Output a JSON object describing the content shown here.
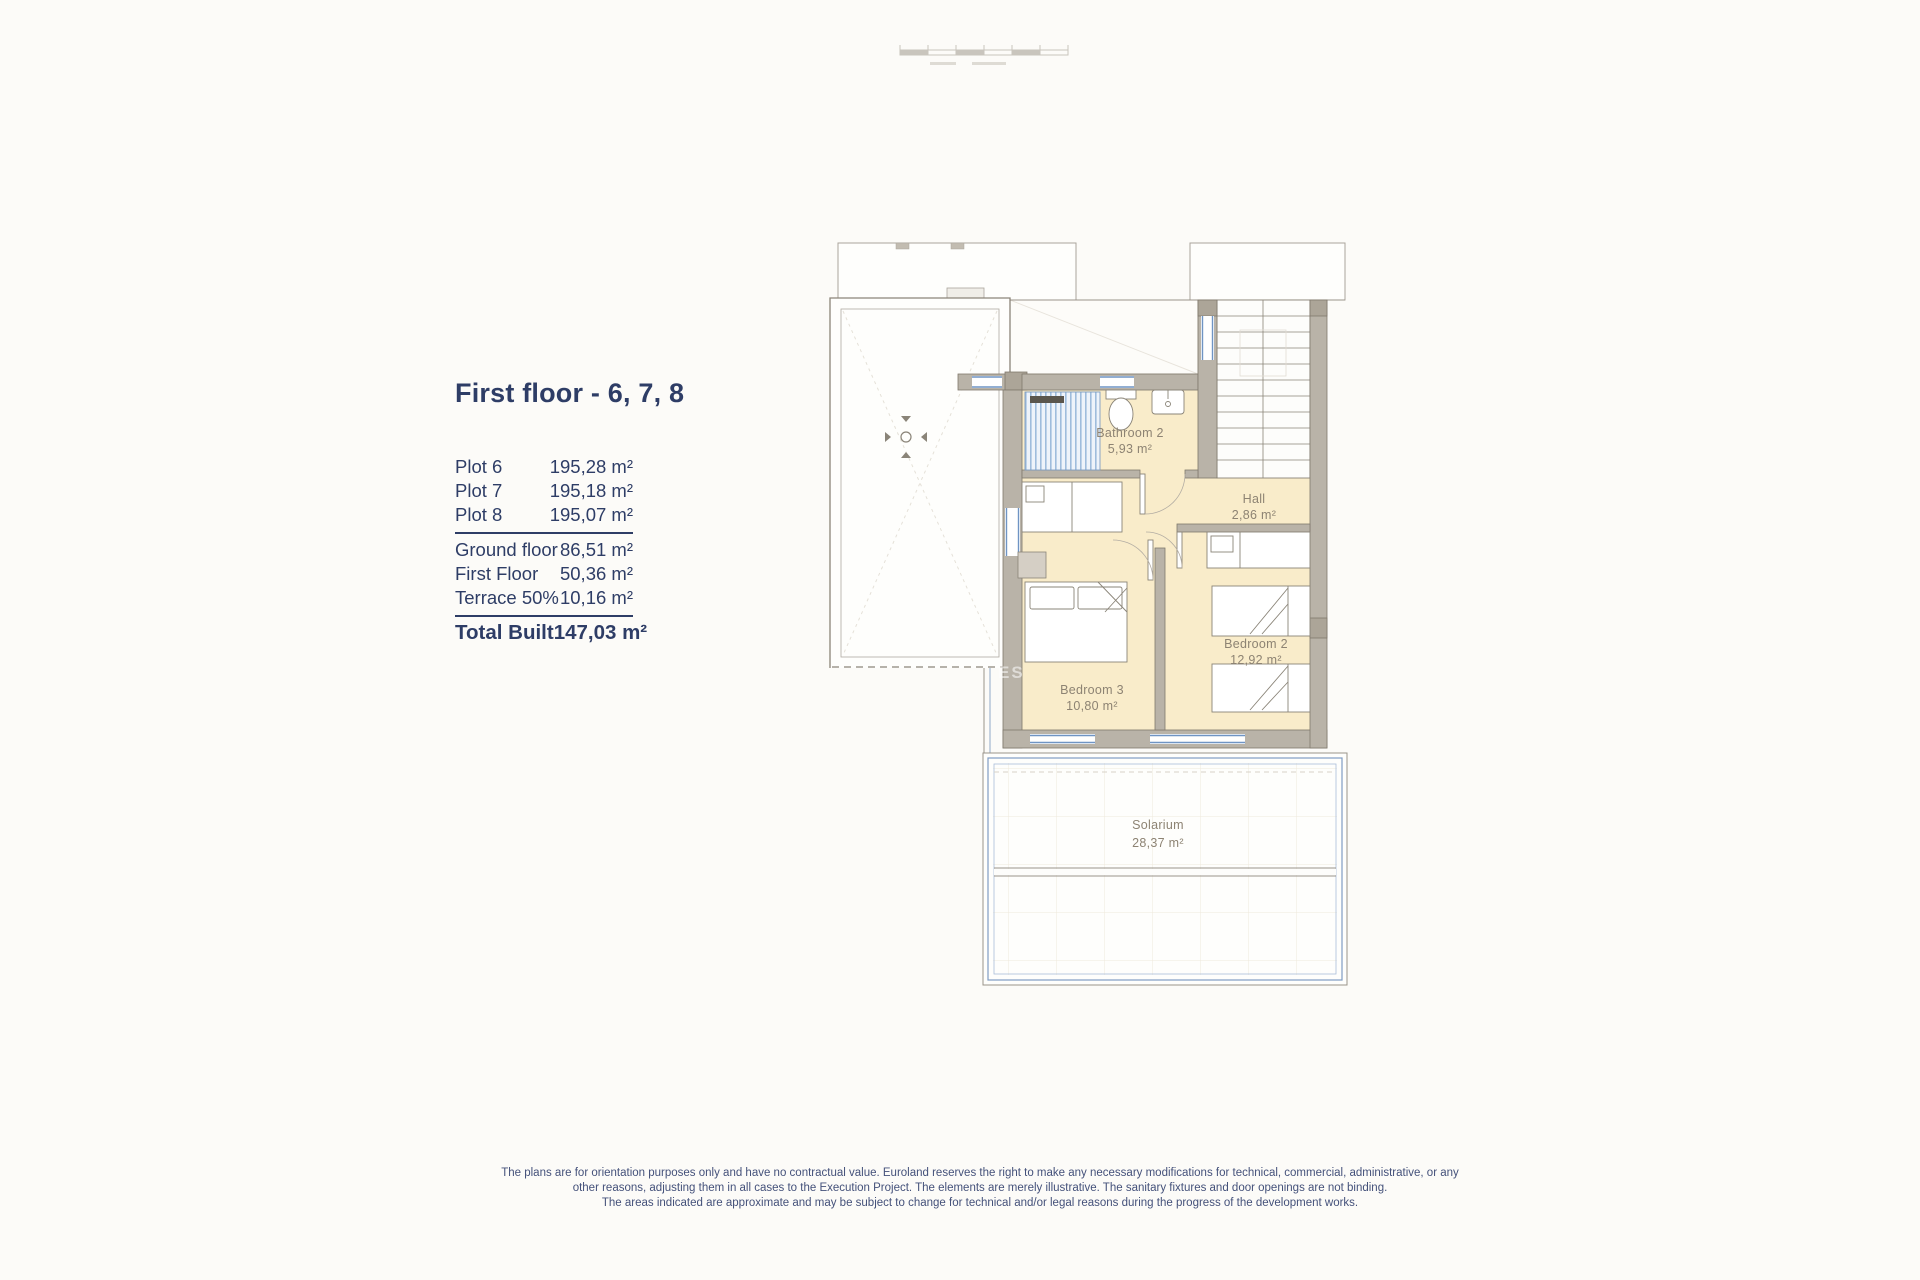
{
  "info_panel": {
    "title": "First floor - 6, 7, 8",
    "plots": [
      {
        "label": "Plot 6",
        "value": "195,28 m²"
      },
      {
        "label": "Plot 7",
        "value": "195,18 m²"
      },
      {
        "label": "Plot 8",
        "value": "195,07 m²"
      }
    ],
    "areas": [
      {
        "label": "Ground floor",
        "value": "86,51 m²"
      },
      {
        "label": "First Floor",
        "value": "50,36 m²"
      },
      {
        "label": "Terrace 50%",
        "value": "10,16 m²"
      }
    ],
    "total": {
      "label": "Total Built",
      "value": "147,03 m²"
    }
  },
  "floor_plan": {
    "rooms": [
      {
        "name": "Bathroom 2",
        "area": "5,93 m²"
      },
      {
        "name": "Hall",
        "area": "2,86 m²"
      },
      {
        "name": "Bedroom 3",
        "area": "10,80 m²"
      },
      {
        "name": "Bedroom 2",
        "area": "12,92 m²"
      },
      {
        "name": "Solarium",
        "area": "28,37 m²"
      }
    ],
    "watermark": "ES"
  },
  "footer": {
    "disclaimer_lines": [
      "The plans are for orientation purposes only and have no contractual value. Euroland reserves the right to make any necessary modifications for technical, commercial, administrative, or any",
      "other reasons, adjusting them in all cases to the Execution Project. The elements are merely illustrative. The sanitary fixtures and door openings are not binding.",
      "The areas indicated are approximate and may be subject to change for technical and/or legal reasons during the progress of the development works."
    ]
  },
  "colors": {
    "accent_navy": "#2e3d66",
    "wall_gray": "#b9b3a8",
    "floor_cream": "#f9ecca",
    "window_blue": "#6f94c4",
    "solarium_blue": "#7f9cc4",
    "label_taupe": "#8d8373"
  }
}
